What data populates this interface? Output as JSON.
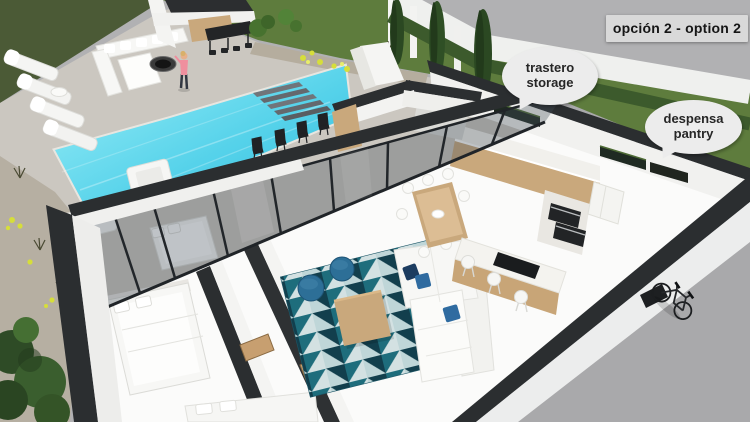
{
  "annotations": {
    "option_label": "opción 2 - option 2",
    "callouts": [
      {
        "name": "storage",
        "line1": "trastero",
        "line2": "storage"
      },
      {
        "name": "pantry",
        "line1": "despensa",
        "line2": "pantry"
      }
    ]
  },
  "colors": {
    "street": "#b1b1b3",
    "grass_dark": "#4b5a36",
    "lawn": "#5e7c3d",
    "hedge": "#3c5a2c",
    "perimeter_wall": "#eff0ee",
    "deck": "#cbc7c0",
    "gravel": "#b6afa2",
    "pool_water": "#4ecfe8",
    "pool_deep": "#2db8da",
    "wall_top": "#2b2e30",
    "house_white": "#f2f2f0",
    "glass": "#43505a",
    "wood": "#c9a87c",
    "island_wood": "#c8a577",
    "rug_teal": "#1e6d7c",
    "rug_navy": "#123f4d",
    "rug_light": "#d3e1e2",
    "pouf_blue": "#2d6f97",
    "pillow_navy": "#1c3c60",
    "pillow_blue": "#2f6ba0",
    "cypress": "#2b4822",
    "bush_green": "#47722f",
    "flower_yellow": "#d6de3a",
    "label_bg": "#d9d9d9",
    "bubble_bg": "#ececec",
    "text_dark": "#1f1f1f"
  }
}
